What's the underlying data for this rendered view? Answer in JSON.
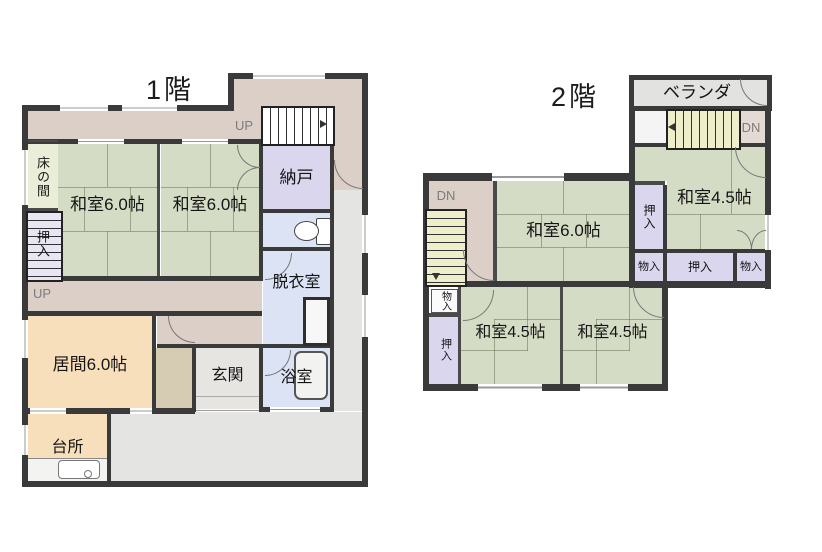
{
  "colors": {
    "wall": "#3a3a3a",
    "tatami_green": "#d5dcc5",
    "hallway_pink": "#dbcfc8",
    "closet_lavender": "#d9d6ee",
    "wetroom_blue": "#dce3f4",
    "living_peach": "#f8dfbc",
    "genkan_gray": "#e6e5e2",
    "exterior_gray": "#e4e4e3",
    "stairs_yellow": "#efeecb",
    "tokonoma_cream": "#eaeed8",
    "closet_tan": "#d6cbb3"
  },
  "floor1": {
    "title": "1階",
    "up_top": "UP",
    "up_left": "UP",
    "tokonoma": "床の間",
    "oshiire": "押入",
    "washitsu_left": "和室6.0帖",
    "washitsu_right": "和室6.0帖",
    "nando": "納戸",
    "datsuishitsu": "脱衣室",
    "yokushitsu": "浴室",
    "genkan": "玄関",
    "ima": "居間6.0帖",
    "daidokoro": "台所"
  },
  "floor2": {
    "title": "2階",
    "veranda": "ベランダ",
    "dn_left": "DN",
    "dn_right": "DN",
    "washitsu_6": "和室6.0帖",
    "washitsu_45_ne": "和室4.5帖",
    "washitsu_45_sw": "和室4.5帖",
    "washitsu_45_se": "和室4.5帖",
    "oshiire_ne": "押入",
    "monoiri_ne_left": "物入",
    "oshiire_ne_mid": "押入",
    "monoiri_ne_right": "物入",
    "monoiri_left": "物入",
    "oshiire_left": "押入"
  }
}
